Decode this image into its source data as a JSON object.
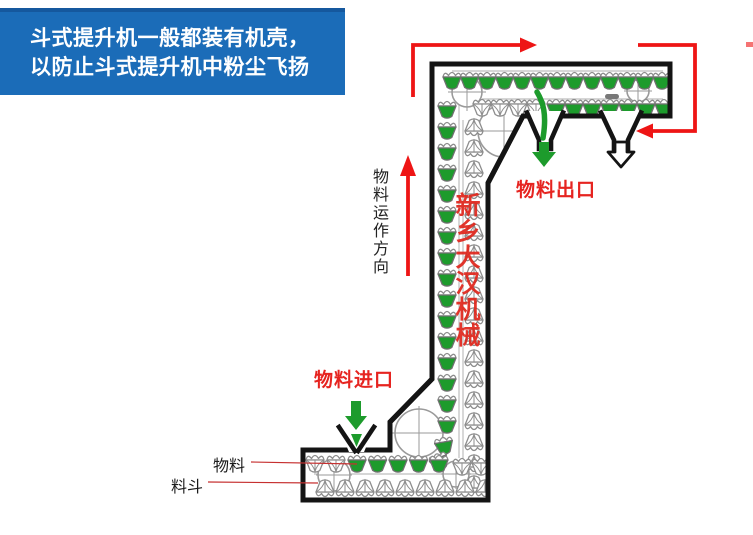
{
  "header": {
    "line1": "斗式提升机一般都装有机壳，",
    "line2": "以防止斗式提升机中粉尘飞扬"
  },
  "labels": {
    "flow_direction": "物料运作方向",
    "outlet": "物料出口",
    "inlet": "物料进口",
    "material": "物料",
    "bucket": "料斗",
    "watermark": "新乡大汉机械"
  },
  "icons": {
    "flow_path_arrow": "red right-angle flow arrows around casing top",
    "flow_up_arrow": "red upward arrow beside elevator column",
    "outlet_arrow": "green down arrow at material outlet",
    "inlet_arrow": "green down arrow at material inlet",
    "spare_outlet_arrow": "hollow down arrow at second outlet",
    "bucket_icon": "elevator bucket (green = full, white = empty)"
  },
  "colors": {
    "header_bg": "#1b6cb8",
    "header_top": "#15589e",
    "header_text": "#ffffff",
    "accent_red": "#ee1515",
    "label_red": "#e62420",
    "watermark_red": "#e0261c",
    "material_green": "#1d9b2c",
    "outline_black": "#141414",
    "bucket_gray": "#8d8d8d",
    "pulley_gray": "#9a9a9a"
  }
}
